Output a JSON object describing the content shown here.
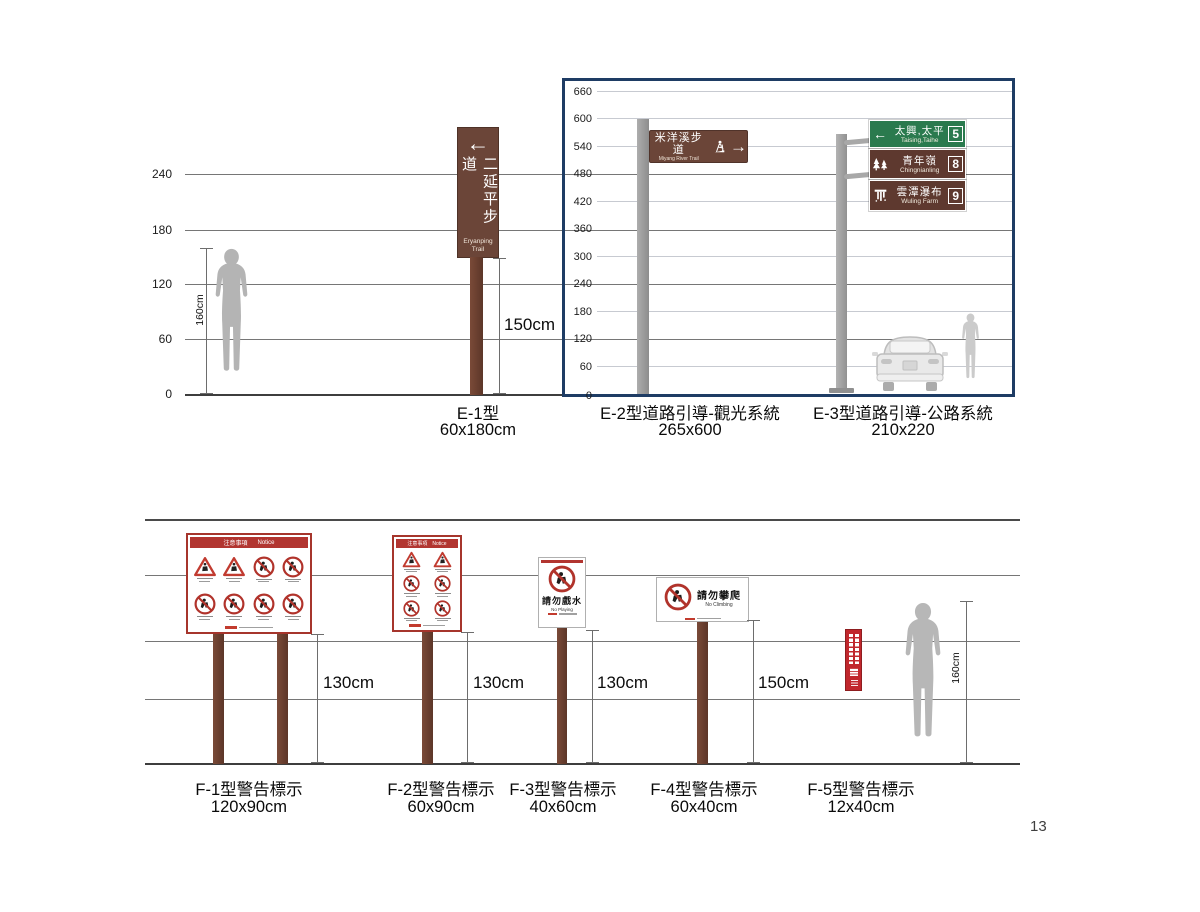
{
  "page_number": "13",
  "colors": {
    "sign_brown": "#6b4538",
    "sign_green": "#2a7a4e",
    "sign_maroon": "#5e392f",
    "frame_navy": "#1e3c64",
    "warning_red": "#b23530",
    "post_brown": "#6e4234"
  },
  "top": {
    "left_scale": [
      "240",
      "180",
      "120",
      "60",
      "0"
    ],
    "person_height": "160cm",
    "e1": {
      "name_zh": "二延平步道",
      "name_en_line1": "Eryanping",
      "name_en_line2": "Trail",
      "height_label": "150cm",
      "caption": "E-1型",
      "size": "60x180cm"
    },
    "frame_scale": [
      "660",
      "600",
      "540",
      "480",
      "420",
      "360",
      "300",
      "240",
      "180",
      "120",
      "60",
      "0"
    ],
    "e2": {
      "name_zh": "米洋溪步道",
      "name_en": "Miyang River Trail",
      "caption": "E-2型道路引導-觀光系統",
      "size": "265x600"
    },
    "e3": {
      "caption": "E-3型道路引導-公路系統",
      "size": "210x220",
      "sign1": {
        "zh": "太興,太平",
        "en": "Taising,Taihe",
        "num": "5"
      },
      "sign2": {
        "zh": "青年嶺",
        "en": "Chingnianling",
        "num": "8"
      },
      "sign3": {
        "zh": "雲潭瀑布",
        "en": "Wuling Farm",
        "num": "9"
      }
    }
  },
  "bottom": {
    "f1": {
      "header_zh": "注意事項",
      "header_en": "Notice",
      "height_label": "130cm",
      "caption": "F-1型警告標示",
      "size": "120x90cm"
    },
    "f2": {
      "header_zh": "注意事項",
      "header_en": "Notice",
      "height_label": "130cm",
      "caption": "F-2型警告標示",
      "size": "60x90cm"
    },
    "f3": {
      "zh": "請勿戲水",
      "en": "No Playing",
      "height_label": "130cm",
      "caption": "F-3型警告標示",
      "size": "40x60cm"
    },
    "f4": {
      "zh": "請勿攀爬",
      "en": "No Climbing",
      "height_label": "150cm",
      "caption": "F-4型警告標示",
      "size": "60x40cm"
    },
    "f5": {
      "caption": "F-5型警告標示",
      "size": "12x40cm"
    },
    "person_height": "160cm"
  }
}
